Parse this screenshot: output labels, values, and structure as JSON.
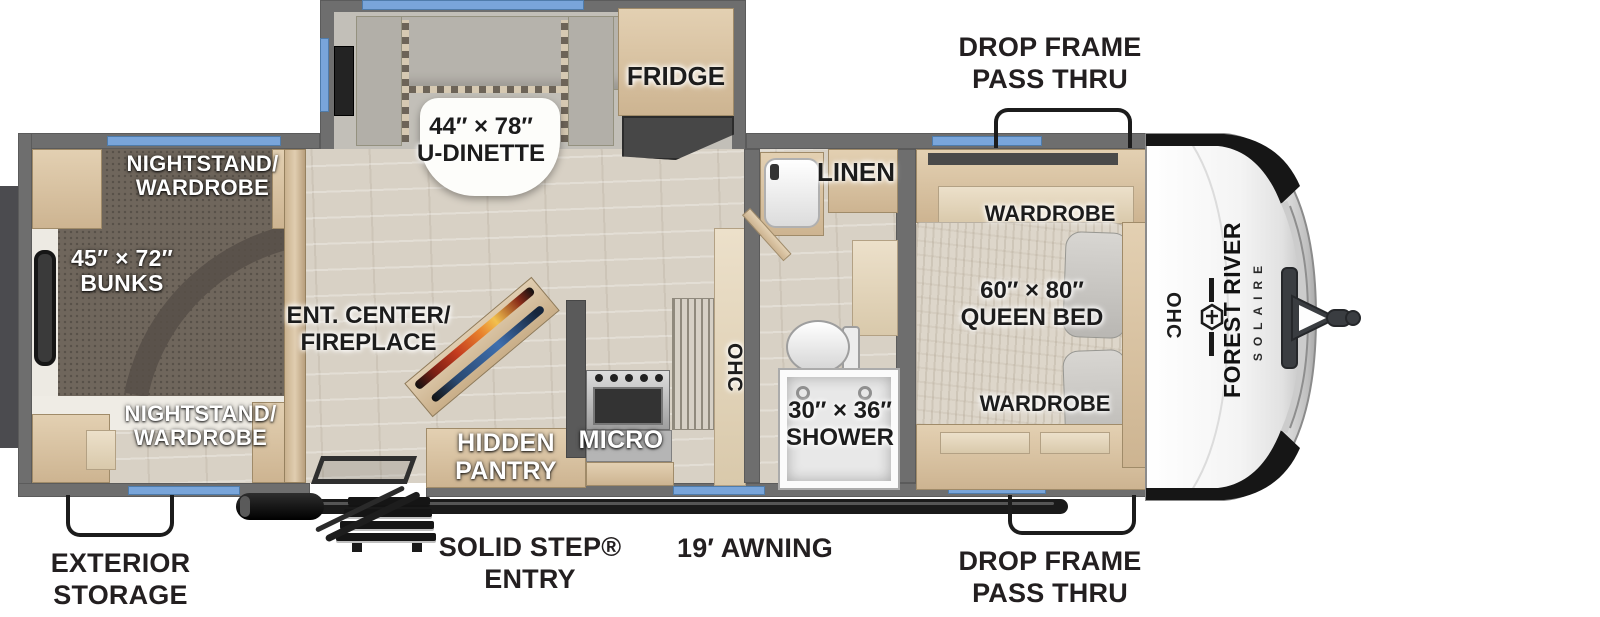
{
  "title": "Solaire travel trailer floor plan",
  "brand": {
    "name": "FOREST RIVER",
    "model": "SOLAIRE"
  },
  "rooms": {
    "rear_bedroom": {
      "nightstand_top": {
        "line1": "NIGHTSTAND/",
        "line2": "WARDROBE"
      },
      "bunks": {
        "line1": "45″ × 72″",
        "line2": "BUNKS"
      },
      "nightstand_bottom": {
        "line1": "NIGHTSTAND/",
        "line2": "WARDROBE"
      }
    },
    "living": {
      "dinette": {
        "line1": "44″ × 78″",
        "line2": "U-DINETTE"
      },
      "fridge": "FRIDGE",
      "ent_center": {
        "line1": "ENT. CENTER/",
        "line2": "FIREPLACE"
      }
    },
    "kitchen": {
      "hidden_pantry": {
        "line1": "HIDDEN",
        "line2": "PANTRY"
      },
      "micro": "MICRO",
      "ohc": "OHC"
    },
    "bathroom": {
      "linen": "LINEN",
      "shower": {
        "line1": "30″ × 36″",
        "line2": "SHOWER"
      }
    },
    "front_bedroom": {
      "wardrobe_top": "WARDROBE",
      "queen_bed": {
        "line1": "60″ × 80″",
        "line2": "QUEEN BED"
      },
      "wardrobe_bottom": "WARDROBE",
      "ohc": "OHC"
    }
  },
  "exterior": {
    "drop_frame_top": {
      "line1": "DROP FRAME",
      "line2": "PASS THRU"
    },
    "drop_frame_bottom": {
      "line1": "DROP FRAME",
      "line2": "PASS THRU"
    },
    "exterior_storage": {
      "line1": "EXTERIOR",
      "line2": "STORAGE"
    },
    "solid_step": {
      "line1": "SOLID STEP®",
      "line2": "ENTRY"
    },
    "awning": "19′ AWNING"
  },
  "palette": {
    "wall_gray": "#6e6e6e",
    "interior_wood_wall": "#d3bd9e",
    "cabinet_wood": "#dcc8aa",
    "floor": "#d8d1c5",
    "carpet": "#6f665c",
    "window_blue": "#79a5da",
    "cushion_gray": "#b6b3ac",
    "mattress": "#ddd6ca",
    "black_accent": "#1a1a1a",
    "label_dark": "#231f20",
    "fireplace_flame": "#e8802c",
    "fireplace_blue": "#3f6fae"
  }
}
